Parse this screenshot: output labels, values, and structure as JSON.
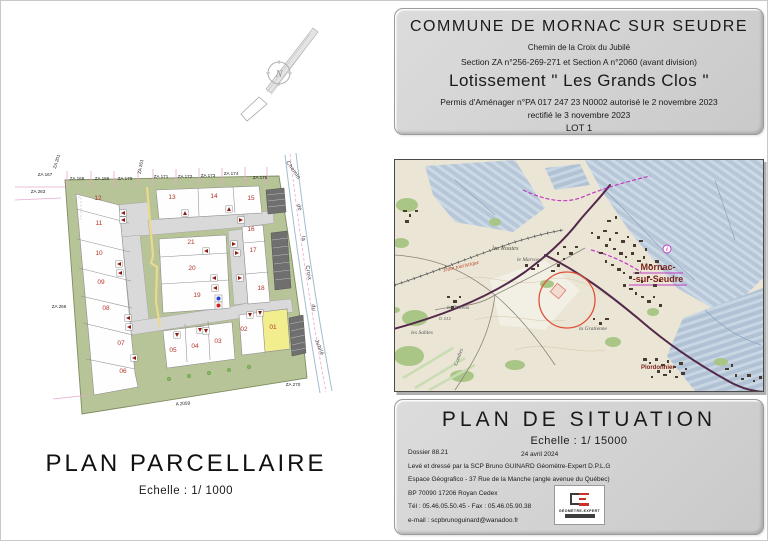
{
  "colors": {
    "lot_number": "#b5342a",
    "lot_highlight": "#f3ee8d",
    "site_green": "#b6c497",
    "road_gray": "#d9d9d9",
    "parking_gray": "#6f6f6f",
    "path_yellow": "#ecd98e",
    "pink_line": "#e9a8cd",
    "town_red": "#7c241c",
    "magenta": "#c23ac2",
    "purple_road": "#53284a",
    "red_circle": "#e0523a"
  },
  "title_block": {
    "commune": "COMMUNE  DE MORNAC SUR SEUDRE",
    "address": "Chemin de la Croix du Jubilé",
    "sections": "Section ZA n°256-269-271 et Section A n°2060 (avant division)",
    "lotissement": "Lotissement  \" Les Grands Clos \"",
    "permis": "Permis d'Aménager n°PA 017 247 23 N0002  autorisé le 2 novembre 2023",
    "rectifie": "rectifié le 3 novembre 2023",
    "lot": "LOT 1"
  },
  "parcel_plan": {
    "title": "PLAN   PARCELLAIRE",
    "scale": "Echelle  : 1/ 1000",
    "compass_n": "N",
    "lots": [
      {
        "n": "12",
        "x": 97,
        "y": 199
      },
      {
        "n": "13",
        "x": 171,
        "y": 198
      },
      {
        "n": "14",
        "x": 213,
        "y": 197
      },
      {
        "n": "15",
        "x": 250,
        "y": 199
      },
      {
        "n": "11",
        "x": 98,
        "y": 224
      },
      {
        "n": "21",
        "x": 190,
        "y": 243
      },
      {
        "n": "16",
        "x": 250,
        "y": 230
      },
      {
        "n": "10",
        "x": 98,
        "y": 254
      },
      {
        "n": "20",
        "x": 191,
        "y": 269
      },
      {
        "n": "17",
        "x": 252,
        "y": 251
      },
      {
        "n": "09",
        "x": 100,
        "y": 283
      },
      {
        "n": "19",
        "x": 196,
        "y": 296
      },
      {
        "n": "18",
        "x": 260,
        "y": 289
      },
      {
        "n": "08",
        "x": 105,
        "y": 309
      },
      {
        "n": "02",
        "x": 243,
        "y": 330
      },
      {
        "n": "01",
        "x": 272,
        "y": 328,
        "highlight": true
      },
      {
        "n": "07",
        "x": 120,
        "y": 344
      },
      {
        "n": "05",
        "x": 172,
        "y": 351
      },
      {
        "n": "04",
        "x": 194,
        "y": 347
      },
      {
        "n": "03",
        "x": 217,
        "y": 342
      },
      {
        "n": "06",
        "x": 122,
        "y": 372
      }
    ],
    "za_labels": [
      {
        "t": "ZA 201",
        "x": 57,
        "y": 161,
        "r": -72
      },
      {
        "t": "ZA 167",
        "x": 44,
        "y": 175
      },
      {
        "t": "ZA 263",
        "x": 37,
        "y": 192
      },
      {
        "t": "ZA 168",
        "x": 76,
        "y": 179
      },
      {
        "t": "ZA 169",
        "x": 101,
        "y": 179
      },
      {
        "t": "ZA 170",
        "x": 124,
        "y": 179
      },
      {
        "t": "ZA 261",
        "x": 141,
        "y": 166,
        "r": -80
      },
      {
        "t": "ZA 171",
        "x": 160,
        "y": 177
      },
      {
        "t": "ZA 172",
        "x": 184,
        "y": 177
      },
      {
        "t": "ZA 173",
        "x": 207,
        "y": 176
      },
      {
        "t": "ZA 174",
        "x": 230,
        "y": 174
      },
      {
        "t": "ZA 175",
        "x": 259,
        "y": 178
      },
      {
        "t": "ZA 266",
        "x": 58,
        "y": 307
      },
      {
        "t": "ZA 270",
        "x": 292,
        "y": 385
      },
      {
        "t": "A 2059",
        "x": 182,
        "y": 404,
        "r": -4
      }
    ],
    "road_words": [
      {
        "t": "Chemin",
        "x": 291,
        "y": 170,
        "r": 55
      },
      {
        "t": "de",
        "x": 297,
        "y": 207,
        "r": 72
      },
      {
        "t": "la",
        "x": 301,
        "y": 238,
        "r": 78
      },
      {
        "t": "Croix",
        "x": 306,
        "y": 272,
        "r": 80
      },
      {
        "t": "du",
        "x": 311,
        "y": 307,
        "r": 82
      },
      {
        "t": "Jubilé",
        "x": 317,
        "y": 347,
        "r": 68
      }
    ],
    "markers": [
      {
        "x": 122,
        "y": 212,
        "d": "l"
      },
      {
        "x": 122,
        "y": 219,
        "d": "l"
      },
      {
        "x": 184,
        "y": 212,
        "d": "u"
      },
      {
        "x": 228,
        "y": 208,
        "d": "u"
      },
      {
        "x": 240,
        "y": 219,
        "d": "r"
      },
      {
        "x": 233,
        "y": 243,
        "d": "r"
      },
      {
        "x": 236,
        "y": 252,
        "d": "r"
      },
      {
        "x": 205,
        "y": 250,
        "d": "l"
      },
      {
        "x": 213,
        "y": 277,
        "d": "l"
      },
      {
        "x": 214,
        "y": 287,
        "d": "l"
      },
      {
        "x": 239,
        "y": 277,
        "d": "r"
      },
      {
        "x": 118,
        "y": 263,
        "d": "l"
      },
      {
        "x": 119,
        "y": 272,
        "d": "l"
      },
      {
        "x": 127,
        "y": 317,
        "d": "l"
      },
      {
        "x": 128,
        "y": 326,
        "d": "l"
      },
      {
        "x": 133,
        "y": 357,
        "d": "l"
      },
      {
        "x": 176,
        "y": 334,
        "d": "d"
      },
      {
        "x": 199,
        "y": 329,
        "d": "d"
      },
      {
        "x": 205,
        "y": 330,
        "d": "d"
      },
      {
        "x": 249,
        "y": 314,
        "d": "d"
      },
      {
        "x": 259,
        "y": 312,
        "d": "d"
      }
    ]
  },
  "situation_map": {
    "labels": [
      {
        "t": "les Routes",
        "x": 97,
        "y": 90,
        "cls": "place-it"
      },
      {
        "t": "le Marvosa",
        "x": 122,
        "y": 101,
        "cls": "place-sm"
      },
      {
        "t": "Mornac-",
        "x": 263,
        "y": 110,
        "cls": "town"
      },
      {
        "t": "-sur-Seudre",
        "x": 263,
        "y": 122,
        "cls": "town"
      },
      {
        "t": "le Callens",
        "x": 52,
        "y": 149,
        "cls": "place-sm"
      },
      {
        "t": "les Sables",
        "x": 16,
        "y": 174,
        "cls": "place-sm"
      },
      {
        "t": "la Gratienne",
        "x": 184,
        "y": 170,
        "cls": "place-sm"
      },
      {
        "t": "Plordonnier",
        "x": 246,
        "y": 209,
        "cls": "town-sm"
      },
      {
        "t": "Combes",
        "x": 62,
        "y": 206,
        "cls": "place-sm",
        "r": -70
      },
      {
        "t": "Train touristique",
        "x": 48,
        "y": 112,
        "cls": "rail",
        "r": -13
      },
      {
        "t": "D 242",
        "x": 44,
        "y": 160,
        "cls": "place-xs"
      },
      {
        "t": "i",
        "x": 272,
        "y": 91,
        "cls": "info-i"
      }
    ]
  },
  "situation_block": {
    "title": "PLAN  DE  SITUATION",
    "scale": "Echelle  : 1/ 15000",
    "dossier": "Dossier 88.21",
    "date": "24 avril 2024",
    "line1": "Levé et dressé par la SCP Bruno GUINARD Géomètre-Expert D.P.L.G",
    "line2": "Espace Géografico - 37 Rue de la Manche (angle avenue du Québec)",
    "line3": "BP 70090 17206 Royan Cedex",
    "line4": "Tél : 05.46.05.50.45 - Fax : 05.46.05.90.38",
    "line5": "e-mail : scpbrunoguinard@wanadoo.fr",
    "logo_caption": "GÉOMÈTRE-EXPERT"
  }
}
